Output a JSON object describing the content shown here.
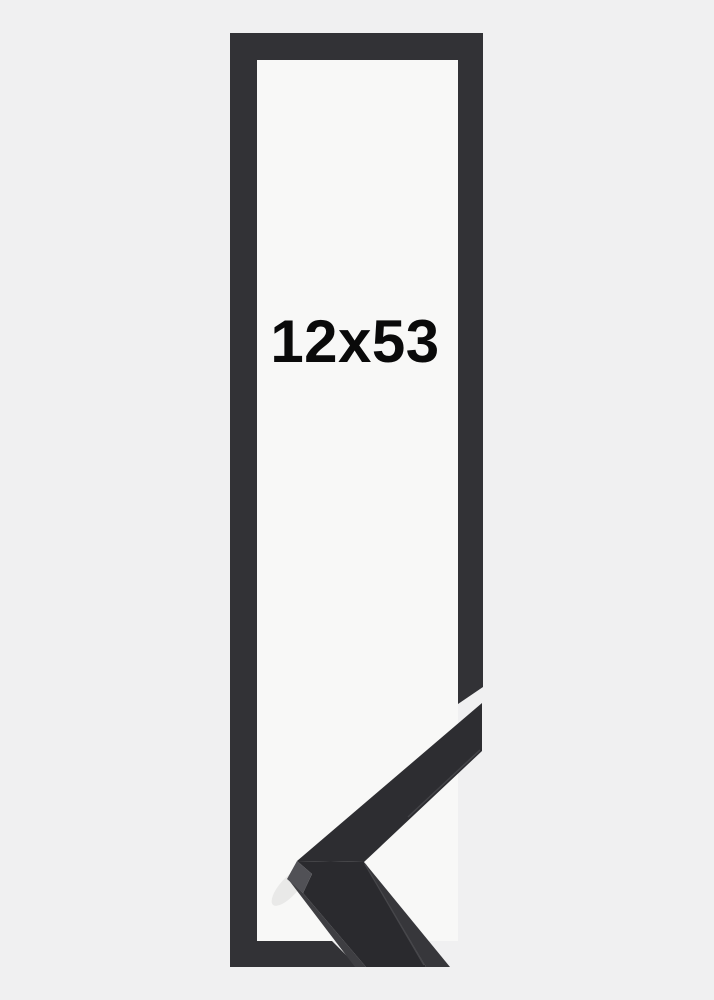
{
  "product": {
    "size_label": "12x53",
    "colors": {
      "background": "#f0f0f1",
      "inner_area": "#f8f8f7",
      "frame_outline": "#323236",
      "sample_upper_arm": "#2d2d31",
      "sample_front": "#2a2a2e",
      "sample_side": "#37373b",
      "sample_left_side": "#3e3e42",
      "sample_miter_facet": "#515156",
      "sample_arris": "#4e4e52",
      "label_text": "#0a0a0a"
    }
  }
}
